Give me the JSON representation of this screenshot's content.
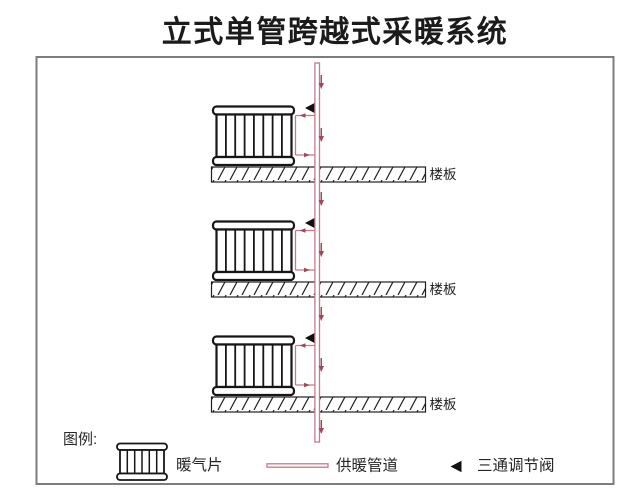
{
  "title": "立式单管跨越式采暖系统",
  "colors": {
    "pipe": "#c5798b",
    "flow_arrow": "#9c4a57",
    "valve": "#111111",
    "line_black": "#161616",
    "frame_gray": "#7d7d7d"
  },
  "floors": [
    {
      "slab_label": "楼板"
    },
    {
      "slab_label": "楼板"
    },
    {
      "slab_label": "楼板"
    }
  ],
  "legend": {
    "heading": "图例:",
    "items": [
      {
        "symbol": "radiator",
        "label": "暖气片"
      },
      {
        "symbol": "supply-pipe",
        "label": "供暖管道"
      },
      {
        "symbol": "three-way-valve",
        "label": "三通调节阀"
      }
    ]
  }
}
